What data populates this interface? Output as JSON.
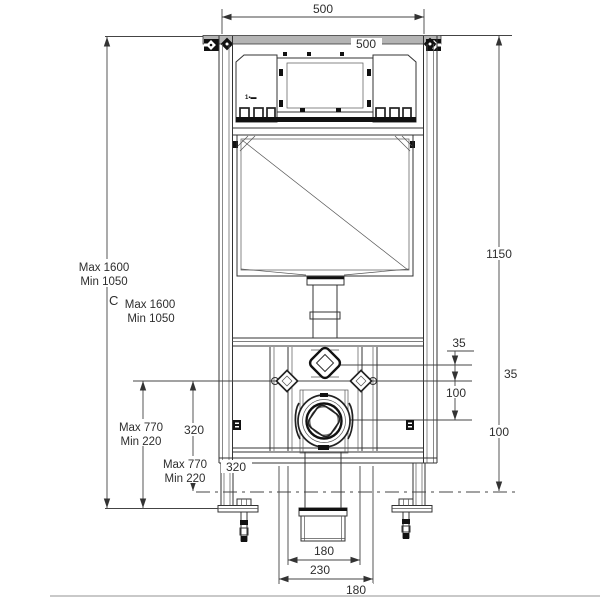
{
  "title": "Wall-hung WC concealed cistern frame installation drawing",
  "colors": {
    "line": "#333333",
    "dark_parts": "#111111",
    "rail_fill": "#b4b4b4",
    "floor_line": "#c9c9c9",
    "text": "#2e2e2e",
    "background": "#ffffff"
  },
  "dimensions": {
    "top_width": "500",
    "top_width_inner": "500",
    "right_height": "1150",
    "right_offset_a": "35",
    "right_offset_b": "100",
    "chain_offset_a": "35",
    "chain_offset_b": "100",
    "left_total_max": "Max 1600",
    "left_total_min": "Min 1050",
    "left_total_c": "C",
    "left_total_max_dup": "Max 1600",
    "left_total_min_dup": "Min 1050",
    "left_lower_max": "Max 770",
    "left_lower_min": "Min 220",
    "left_lower_max_dup": "Max 770",
    "left_lower_min_dup": "Min 220",
    "outlet_height": "320",
    "outlet_height_dup": "320",
    "bottom_width_inner": "180",
    "bottom_width_outer": "230",
    "bottom_width_dup": "180"
  },
  "annotations": {
    "cistern_logo": "1▪▬"
  }
}
